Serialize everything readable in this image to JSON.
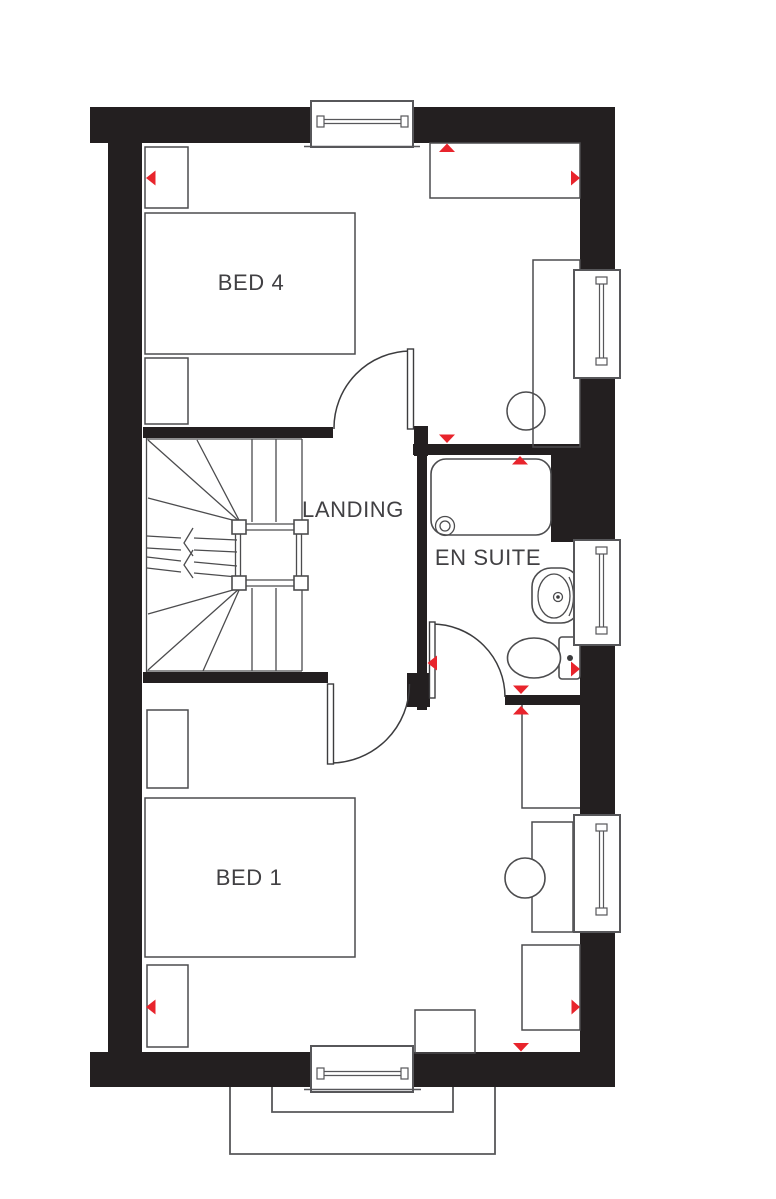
{
  "plan": {
    "labels": {
      "bed4": "BED 4",
      "landing": "LANDING",
      "en_suite": "EN SUITE",
      "bed1": "BED 1"
    },
    "colors": {
      "wall": "#231f20",
      "line": "#4c4c4e",
      "frame": "#57575a",
      "accent": "#e8242c",
      "text": "#414043",
      "background": "#ffffff"
    },
    "fixtures": [
      "staircase",
      "bath",
      "pedestal-basin",
      "toilet",
      "hot-water-cylinder",
      "double-bed",
      "wardrobe",
      "cupboard",
      "bedside-table",
      "dressing-table",
      "stool",
      "ottoman"
    ],
    "window_count": 5,
    "door_count": 3,
    "direction_marker_count": 12
  }
}
